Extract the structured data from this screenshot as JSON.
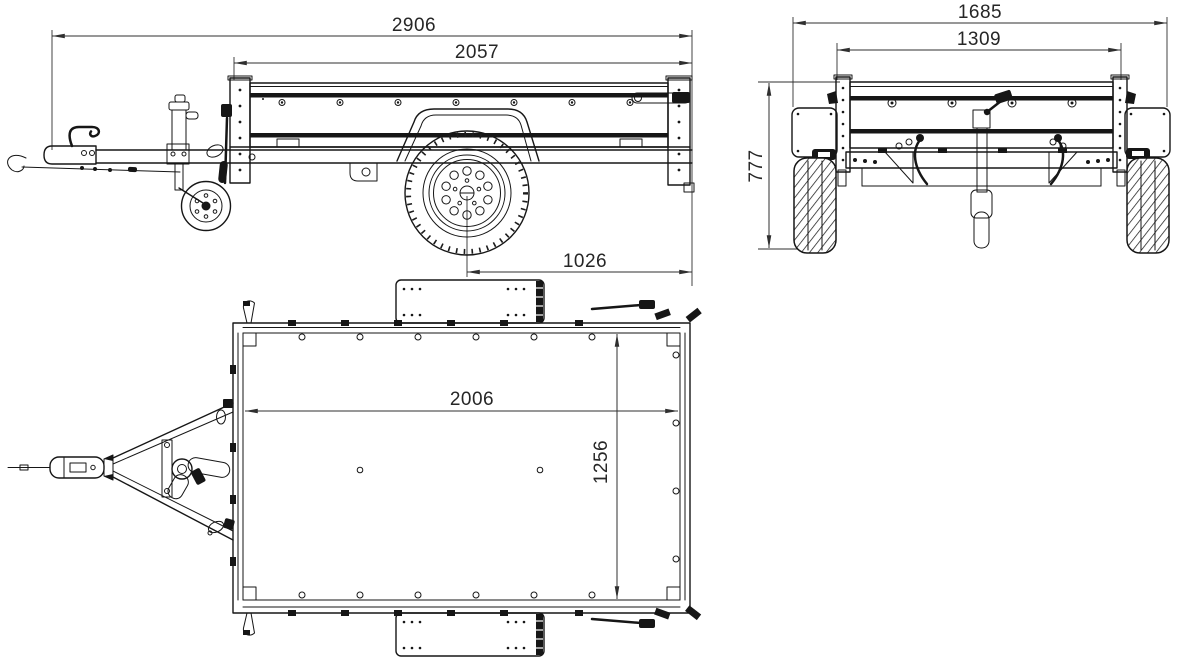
{
  "document": {
    "type": "technical-drawing",
    "subject": "single-axle box utility trailer, three orthographic views",
    "units": "mm"
  },
  "views": [
    {
      "id": "side-view",
      "label": "side profile view"
    },
    {
      "id": "rear-view",
      "label": "rear view"
    },
    {
      "id": "top-view",
      "label": "top plan view"
    }
  ],
  "dimensions": {
    "side": {
      "overall_length": "2906",
      "box_length": "2057",
      "axle_to_rear": "1026"
    },
    "rear": {
      "overall_width": "1685",
      "box_width": "1309",
      "height": "777"
    },
    "top": {
      "inner_length": "2006",
      "inner_width": "1256"
    }
  },
  "colors": {
    "background": "#ffffff",
    "part_line": "#161616",
    "dimension_line": "#2f2f2f",
    "dimension_text": "#262626"
  }
}
